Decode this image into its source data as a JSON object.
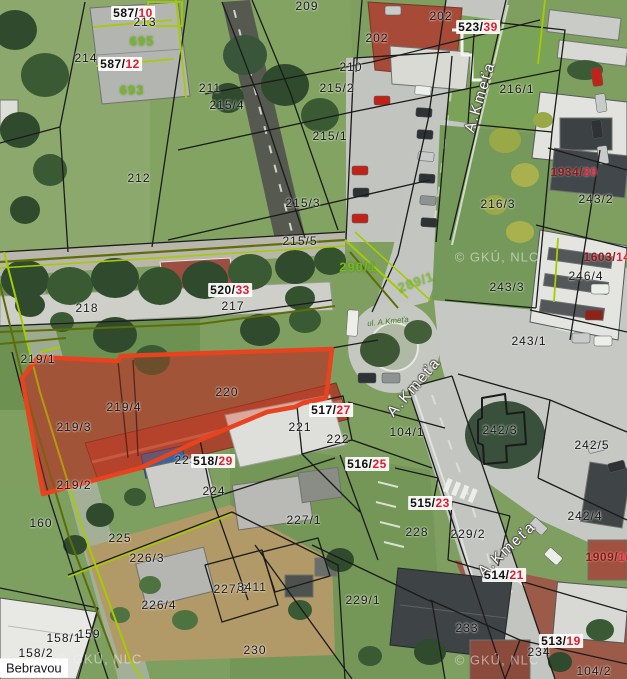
{
  "map": {
    "description": "cadastral aerial map viewer",
    "highlight_border_color": "#e8431e",
    "highlight_fill_color": "rgba(210,59,32,0.33)",
    "parcel_line_color": "#1b1b1b",
    "olive_line_color": "#5f6d08",
    "chartreuse_line_color": "#a4cc00",
    "green_label_color": "#6fbf12",
    "red_suffix_color": "#e8192c",
    "maroon_prefix_color": "#991414",
    "watermark_text": "© GKÚ, NLC"
  },
  "labels": [
    {
      "t": "halo",
      "p": "587/",
      "s": "10",
      "x": 133,
      "y": 13
    },
    {
      "t": "black",
      "n": "213",
      "x": 145,
      "y": 22
    },
    {
      "t": "green",
      "n": "695",
      "x": 142,
      "y": 41
    },
    {
      "t": "black",
      "n": "214",
      "x": 86,
      "y": 58
    },
    {
      "t": "halo",
      "p": "587/",
      "s": "12",
      "x": 120,
      "y": 64
    },
    {
      "t": "green",
      "n": "693",
      "x": 132,
      "y": 90
    },
    {
      "t": "black",
      "n": "211",
      "x": 210,
      "y": 88
    },
    {
      "t": "black",
      "n": "215/4",
      "x": 227,
      "y": 105
    },
    {
      "t": "black",
      "n": "209",
      "x": 307,
      "y": 6
    },
    {
      "t": "black",
      "n": "202",
      "x": 441,
      "y": 16
    },
    {
      "t": "black",
      "n": "202",
      "x": 377,
      "y": 38
    },
    {
      "t": "black",
      "n": "210",
      "x": 351,
      "y": 67
    },
    {
      "t": "black",
      "n": "215/2",
      "x": 337,
      "y": 88
    },
    {
      "t": "black",
      "n": "215/1",
      "x": 330,
      "y": 136
    },
    {
      "t": "halo",
      "p": "523/",
      "s": "39",
      "x": 478,
      "y": 27
    },
    {
      "t": "black",
      "n": "216/1",
      "x": 517,
      "y": 89
    },
    {
      "t": "maroon",
      "p": "1934/",
      "s": "20",
      "x": 574,
      "y": 172
    },
    {
      "t": "black",
      "n": "243/2",
      "x": 596,
      "y": 199
    },
    {
      "t": "black",
      "n": "216/3",
      "x": 498,
      "y": 204
    },
    {
      "t": "black",
      "n": "212",
      "x": 139,
      "y": 178
    },
    {
      "t": "black",
      "n": "215/3",
      "x": 303,
      "y": 203
    },
    {
      "t": "black",
      "n": "215/5",
      "x": 300,
      "y": 241
    },
    {
      "t": "maroon",
      "p": "1603/",
      "s": "14",
      "x": 607,
      "y": 257
    },
    {
      "t": "black",
      "n": "246/4",
      "x": 586,
      "y": 276
    },
    {
      "t": "black",
      "n": "243/3",
      "x": 507,
      "y": 287
    },
    {
      "t": "green",
      "n": "290/1",
      "x": 358,
      "y": 267
    },
    {
      "t": "green",
      "n": "289/1",
      "x": 416,
      "y": 282,
      "r": -20,
      "o": 0.75
    },
    {
      "t": "black",
      "n": "218",
      "x": 87,
      "y": 308
    },
    {
      "t": "black",
      "n": "217",
      "x": 233,
      "y": 306
    },
    {
      "t": "halo",
      "p": "520/",
      "s": "33",
      "x": 230,
      "y": 290
    },
    {
      "t": "black",
      "n": "243/1",
      "x": 529,
      "y": 341
    },
    {
      "t": "black",
      "n": "219/1",
      "x": 38,
      "y": 359
    },
    {
      "t": "black",
      "n": "220",
      "x": 227,
      "y": 392
    },
    {
      "t": "black",
      "n": "219/4",
      "x": 124,
      "y": 407
    },
    {
      "t": "black",
      "n": "219/3",
      "x": 74,
      "y": 427
    },
    {
      "t": "black",
      "n": "221",
      "x": 300,
      "y": 427
    },
    {
      "t": "halo",
      "p": "517/",
      "s": "27",
      "x": 331,
      "y": 410
    },
    {
      "t": "black",
      "n": "104/1",
      "x": 407,
      "y": 432
    },
    {
      "t": "black",
      "n": "222",
      "x": 338,
      "y": 439
    },
    {
      "t": "black",
      "n": "242/3",
      "x": 500,
      "y": 430
    },
    {
      "t": "black",
      "n": "242/5",
      "x": 592,
      "y": 445
    },
    {
      "t": "black",
      "n": "223",
      "x": 186,
      "y": 460
    },
    {
      "t": "halo",
      "p": "518/",
      "s": "29",
      "x": 213,
      "y": 461
    },
    {
      "t": "halo",
      "p": "516/",
      "s": "25",
      "x": 367,
      "y": 464
    },
    {
      "t": "black",
      "n": "219/2",
      "x": 74,
      "y": 485
    },
    {
      "t": "black",
      "n": "224",
      "x": 214,
      "y": 491
    },
    {
      "t": "halo",
      "p": "515/",
      "s": "23",
      "x": 430,
      "y": 503
    },
    {
      "t": "black",
      "n": "242/4",
      "x": 585,
      "y": 516
    },
    {
      "t": "black",
      "n": "227/1",
      "x": 304,
      "y": 520
    },
    {
      "t": "black",
      "n": "160",
      "x": 41,
      "y": 523
    },
    {
      "t": "black",
      "n": "228",
      "x": 417,
      "y": 532
    },
    {
      "t": "black",
      "n": "229/2",
      "x": 468,
      "y": 534
    },
    {
      "t": "black",
      "n": "225",
      "x": 120,
      "y": 538
    },
    {
      "t": "black",
      "n": "226/3",
      "x": 147,
      "y": 558
    },
    {
      "t": "halo",
      "p": "514/",
      "s": "21",
      "x": 504,
      "y": 575
    },
    {
      "t": "maroon",
      "p": "1909/",
      "s": "16",
      "x": 609,
      "y": 557
    },
    {
      "t": "black",
      "n": "227/2",
      "x": 231,
      "y": 589
    },
    {
      "t": "black",
      "n": "3411",
      "x": 252,
      "y": 587
    },
    {
      "t": "black",
      "n": "229/1",
      "x": 363,
      "y": 600
    },
    {
      "t": "black",
      "n": "226/4",
      "x": 159,
      "y": 605
    },
    {
      "t": "black",
      "n": "233",
      "x": 467,
      "y": 628
    },
    {
      "t": "black",
      "n": "158/1",
      "x": 64,
      "y": 638
    },
    {
      "t": "black",
      "n": "159",
      "x": 89,
      "y": 634
    },
    {
      "t": "halo",
      "p": "513/",
      "s": "19",
      "x": 561,
      "y": 641
    },
    {
      "t": "black",
      "n": "230",
      "x": 255,
      "y": 650
    },
    {
      "t": "black",
      "n": "234",
      "x": 539,
      "y": 652
    },
    {
      "t": "black",
      "n": "158/2",
      "x": 36,
      "y": 653
    },
    {
      "t": "black",
      "n": "104/2",
      "x": 594,
      "y": 671
    },
    {
      "t": "street",
      "n": "A.Kmeťa",
      "x": 480,
      "y": 97,
      "r": -73
    },
    {
      "t": "street",
      "n": "A.Kmeťa",
      "x": 414,
      "y": 387,
      "r": -49
    },
    {
      "t": "street",
      "n": "A.Kmeťa",
      "x": 507,
      "y": 549,
      "r": -43
    },
    {
      "t": "green-small",
      "n": "ul. A.Kmeťa",
      "x": 388,
      "y": 322,
      "r": -6
    },
    {
      "t": "boxed",
      "n": "Bebravou",
      "x": 0,
      "y": 668
    },
    {
      "t": "watermark",
      "n": "© GKÚ, NLC",
      "x": 497,
      "y": 257
    },
    {
      "t": "watermark",
      "n": "© GKÚ, NLC",
      "x": 100,
      "y": 659
    },
    {
      "t": "watermark",
      "n": "© GKÚ, NLC",
      "x": 497,
      "y": 660
    }
  ]
}
